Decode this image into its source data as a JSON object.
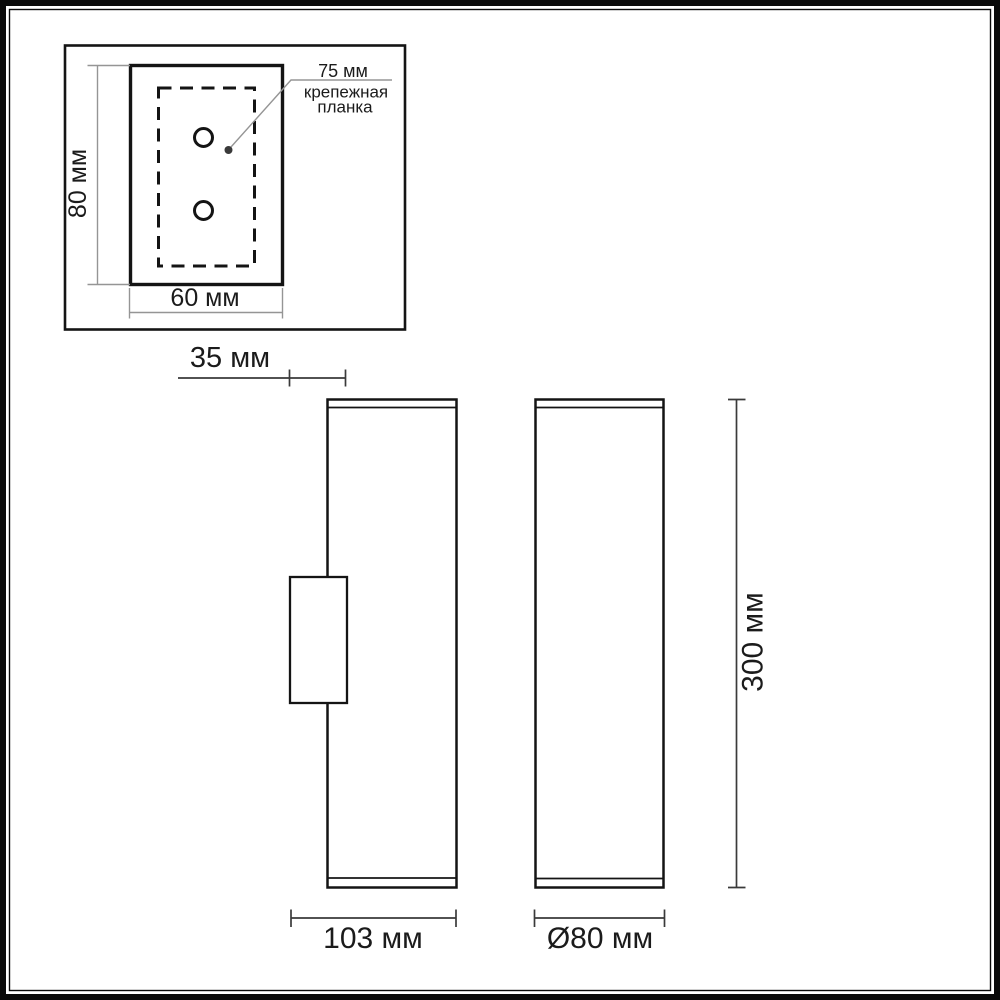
{
  "inset_panel": {
    "plate_height_label": "80 мм",
    "plate_width_label": "60 мм",
    "callout": {
      "dimension": "75 мм",
      "line1": "крепежная",
      "line2": "планка"
    }
  },
  "side_view": {
    "bracket_depth_label": "35 мм",
    "overall_depth_label": "103 мм"
  },
  "front_view": {
    "diameter_label": "Ø80 мм",
    "height_label": "300 мм"
  },
  "colors": {
    "object_line": "#141414",
    "dimension_line_dark": "#3a3a3a",
    "dimension_line_light": "#959595",
    "background": "#ffffff"
  }
}
